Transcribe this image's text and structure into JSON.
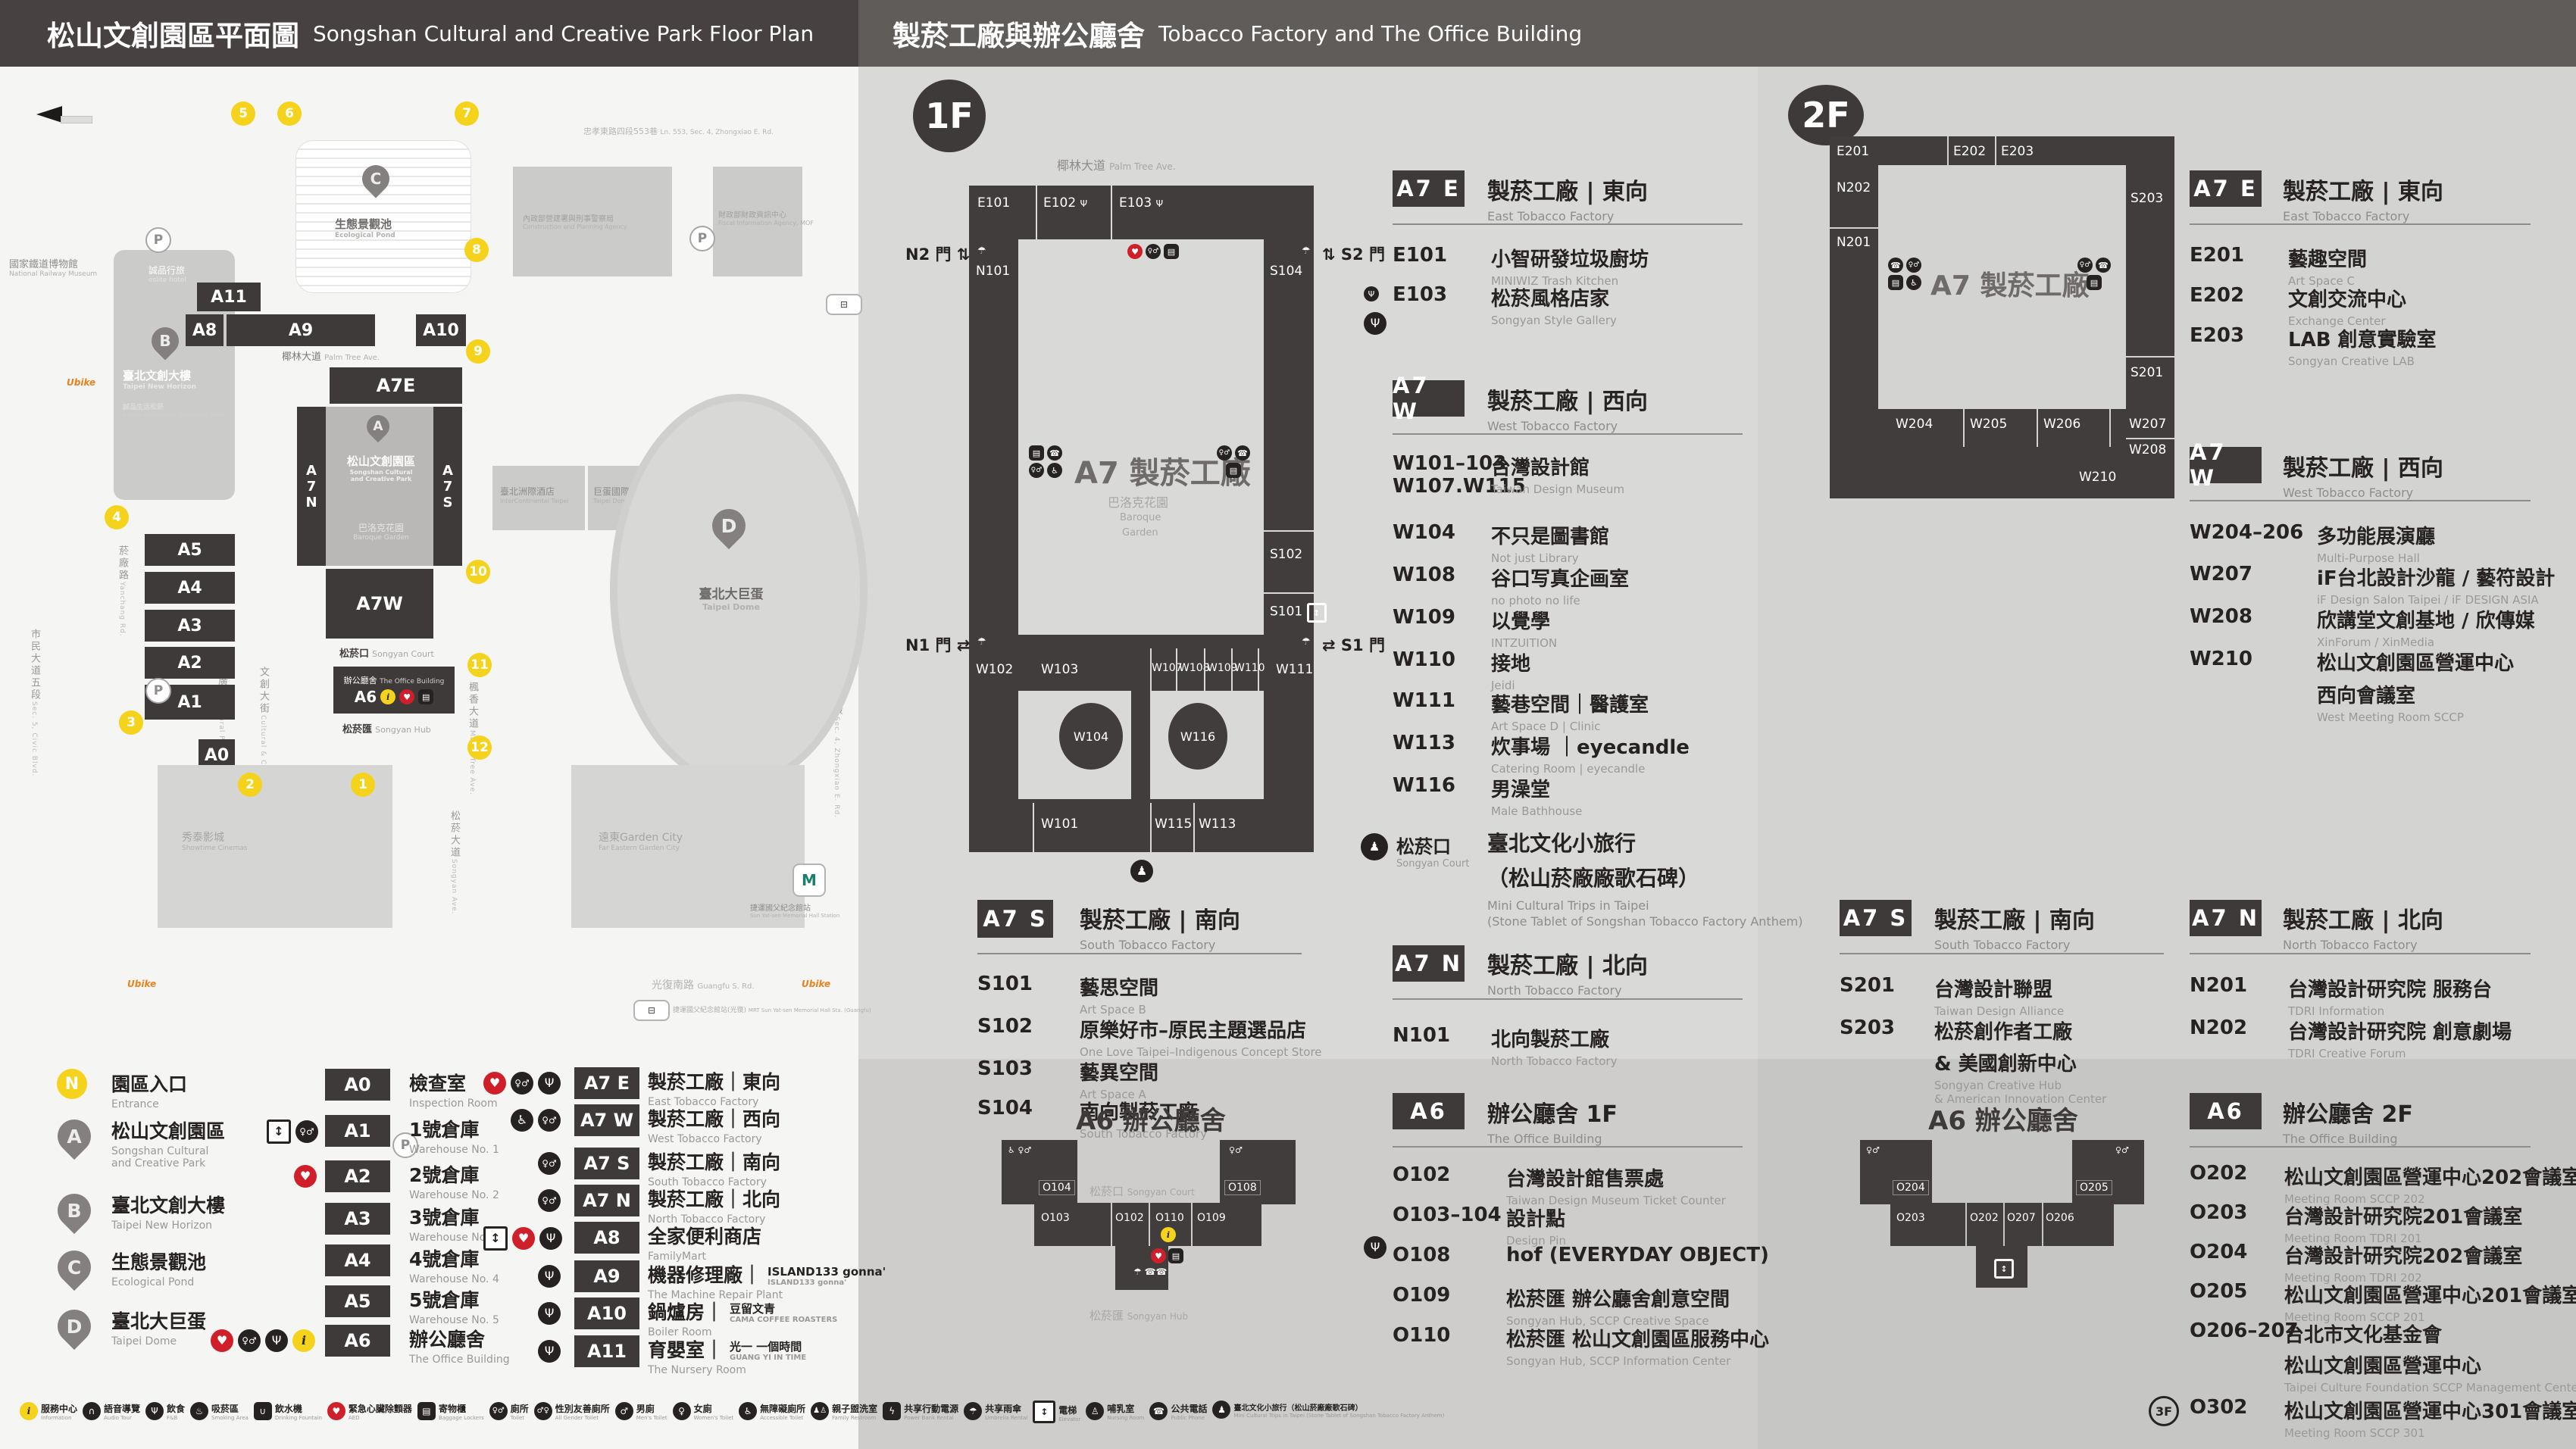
{
  "header": {
    "title_left_zh": "松山文創園區平面圖",
    "title_left_en": "Songshan Cultural and Creative Park Floor Plan",
    "title_right_zh": "製菸工廠與辦公廳舍",
    "title_right_en": "Tobacco Factory and The Office Building"
  },
  "icons": {
    "info": "i",
    "food": "Ψ",
    "restroom": "♀♂",
    "male": "♂",
    "female": "♀",
    "accessible": "♿",
    "aed": "♥",
    "elevator": "↕",
    "locker": "▤",
    "umbrella": "☂",
    "phone": "☎",
    "statue": "♟",
    "audio": "∩",
    "water": "∪",
    "smoking": "♨",
    "family": "♟♙",
    "power": "ϟ",
    "nursing": "♙",
    "parking": "P"
  },
  "map": {
    "compass": "N",
    "roads": {
      "top": {
        "zh": "忠孝東路四段553巷",
        "en": "Ln. 553, Sec. 4, Zhongxiao E. Rd."
      },
      "left_outer": {
        "zh": "市民大道五段",
        "en": "Sec. 5, Civic Blvd."
      },
      "left_inner": {
        "zh": "菸廠路",
        "en": "Yanchang Rd."
      },
      "right": {
        "zh": "忠孝東路四段",
        "en": "Sec. 4, Zhongxiao E. Rd."
      },
      "bottom": {
        "zh": "光復南路",
        "en": "Guangfu S. Rd."
      },
      "songyan": {
        "zh": "松菸大道",
        "en": "Songyan Ave."
      },
      "palm": {
        "zh": "椰林大道",
        "en": "Palm Tree Ave."
      },
      "maple": {
        "zh": "楓香大道",
        "en": "Maple Tree Ave."
      },
      "cultural_blvd": {
        "zh": "文創大街",
        "en": "Cultural & Creative Blvd."
      },
      "cultural_plaza": {
        "zh": "文化廣場",
        "en": "Cultural Plaza"
      }
    },
    "pois": {
      "railway_museum": {
        "zh": "國家鐵道博物館",
        "en": "National Railway Museum"
      },
      "eslite_hotel": {
        "zh": "誠品行旅",
        "en": "eslite hotel"
      },
      "new_horizon": {
        "zh": "臺北文創大樓",
        "en": "Taipei New Horizon"
      },
      "eslite_mall": {
        "zh": "誠品生活松菸",
        "en": "eslite spectrum Songyan Mall"
      },
      "cpa": {
        "zh": "內政部營建署與刑事警察局",
        "en": "Construction and Planning Agency"
      },
      "fia": {
        "zh": "財政部財政資訊中心",
        "en": "Fiscal Information Agency, MOF"
      },
      "intercontinental": {
        "zh": "臺北洲際酒店",
        "en": "InterContinental Taipei"
      },
      "dome_center": {
        "zh": "巨蛋國際中心",
        "en": "Taipei Dome Int'l Center"
      },
      "showtime": {
        "zh": "秀泰影城",
        "en": "Showtime Cinemas"
      },
      "garden_city": {
        "zh": "遠東Garden City",
        "en": "Far Eastern Garden City"
      },
      "mrt": {
        "zh": "捷運國父紀念館站",
        "en": "Sun Yat-sen Memorial Hall Station"
      },
      "bus": {
        "zh": "捷運國父紀念館站(光復)",
        "en": "MRT Sun Yat-sen Memorial Hall Sta. (Guangfu)"
      },
      "ubike": "Ubike"
    },
    "pond": {
      "zh": "生態景觀池",
      "en": "Ecological Pond"
    },
    "dome": {
      "zh": "臺北大巨蛋",
      "en": "Taipei Dome"
    },
    "park": {
      "zh": "松山文創園區",
      "en1": "Songshan Cultural",
      "en2": "and Creative Park"
    },
    "baroque": {
      "zh": "巴洛克花園",
      "en": "Baroque Garden"
    },
    "court": {
      "zh": "松菸口",
      "en": "Songyan Court"
    },
    "hub": {
      "zh": "松菸匯",
      "en": "Songyan Hub"
    },
    "office_bar": {
      "zh": "辦公廳舍",
      "en": "The Office Building",
      "code": "A6"
    },
    "blocks": {
      "a11": "A11",
      "a8": "A8",
      "a9": "A9",
      "a10": "A10",
      "a7e": "A7E",
      "a7w": "A7W",
      "a7n": "A7N",
      "a7s": "A7S",
      "a0": "A0",
      "a1": "A1",
      "a2": "A2",
      "a3": "A3",
      "a4": "A4",
      "a5": "A5"
    },
    "entrances": [
      "1",
      "2",
      "3",
      "4",
      "5",
      "6",
      "7",
      "8",
      "9",
      "10",
      "11",
      "12"
    ]
  },
  "legend": {
    "markers": [
      {
        "key": "N",
        "zh": "園區入口",
        "en": "Entrance"
      },
      {
        "key": "A",
        "zh": "松山文創園區",
        "en1": "Songshan Cultural",
        "en2": "and Creative Park"
      },
      {
        "key": "B",
        "zh": "臺北文創大樓",
        "en1": "Taipei New Horizon",
        "en2": ""
      },
      {
        "key": "C",
        "zh": "生態景觀池",
        "en1": "Ecological Pond",
        "en2": ""
      },
      {
        "key": "D",
        "zh": "臺北大巨蛋",
        "en1": "Taipei Dome",
        "en2": ""
      }
    ],
    "col_a": [
      {
        "code": "A0",
        "zh": "檢查室",
        "en": "Inspection Room"
      },
      {
        "code": "A1",
        "zh": "1號倉庫",
        "en": "Warehouse No. 1"
      },
      {
        "code": "A2",
        "zh": "2號倉庫",
        "en": "Warehouse No. 2"
      },
      {
        "code": "A3",
        "zh": "3號倉庫",
        "en": "Warehouse No. 3"
      },
      {
        "code": "A4",
        "zh": "4號倉庫",
        "en": "Warehouse No. 4"
      },
      {
        "code": "A5",
        "zh": "5號倉庫",
        "en": "Warehouse No. 5"
      },
      {
        "code": "A6",
        "zh": "辦公廳舍",
        "en": "The Office Building"
      }
    ],
    "col_b": [
      {
        "code": "A7 E",
        "zh": "製菸工廠｜東向",
        "en": "East Tobacco Factory"
      },
      {
        "code": "A7 W",
        "zh": "製菸工廠｜西向",
        "en": "West Tobacco Factory"
      },
      {
        "code": "A7 S",
        "zh": "製菸工廠｜南向",
        "en": "South Tobacco Factory"
      },
      {
        "code": "A7 N",
        "zh": "製菸工廠｜北向",
        "en": "North Tobacco Factory"
      },
      {
        "code": "A8",
        "zh": "全家便利商店",
        "en": "FamilyMart"
      },
      {
        "code": "A9",
        "zh": "機器修理廠｜",
        "sub1": "ISLAND133 gonna'",
        "sub2": "ISLAND133 gonna'",
        "en": "The Machine Repair Plant"
      },
      {
        "code": "A10",
        "zh": "鍋爐房｜",
        "sub1": "豆留文青",
        "sub2": "CAMA COFFEE ROASTERS",
        "en": "Boiler Room"
      },
      {
        "code": "A11",
        "zh": "育嬰室｜",
        "sub1": "光一 一個時間",
        "sub2": "GUANG YI IN TIME",
        "en": "The Nursery Room"
      }
    ]
  },
  "f1": {
    "badge": "1F",
    "plan": {
      "e101": "E101",
      "e102": "E102",
      "e103": "E103",
      "n101": "N101",
      "s101": "S101",
      "s102": "S102",
      "s103": "S103",
      "s104": "S104",
      "w101": "W101",
      "w102": "W102",
      "w103": "W103",
      "w104": "W104",
      "w107": "W107",
      "w108": "W108",
      "w109": "W109",
      "w110": "W110",
      "w111": "W111",
      "w113": "W113",
      "w115": "W115",
      "w116": "W116",
      "n1": "N1 門",
      "n2": "N2 門",
      "s1": "S1 門",
      "s2": "S2 門",
      "a7": "A7 製菸工廠"
    },
    "a7e": {
      "code": "A7 E",
      "zh": "製菸工廠 | 東向",
      "en": "East Tobacco Factory",
      "rooms": [
        {
          "code": "E101",
          "zh": "小智研發垃圾廚坊",
          "en": "MINIWIZ Trash Kitchen"
        },
        {
          "code": "E103",
          "zh": "松菸風格店家",
          "en": "Songyan Style Gallery"
        }
      ]
    },
    "a7w": {
      "code": "A7 W",
      "zh": "製菸工廠 | 西向",
      "en": "West Tobacco Factory",
      "rooms": [
        {
          "code": "W101–103",
          "code2": "W107.W115",
          "zh": "台灣設計館",
          "en": "Taiwan Design Museum"
        },
        {
          "code": "W104",
          "zh": "不只是圖書館",
          "en": "Not just Library"
        },
        {
          "code": "W108",
          "zh": "谷口写真企画室",
          "en": "no photo no life"
        },
        {
          "code": "W109",
          "zh": "以覺學",
          "en": "INTZUITION"
        },
        {
          "code": "W110",
          "zh": "接地",
          "en": "Jeidi"
        },
        {
          "code": "W111",
          "zh": "藝巷空間｜醫護室",
          "en": "Art Space D | Clinic"
        },
        {
          "code": "W113",
          "zh": "炊事場 ｜eyecandle",
          "en": "Catering Room | eyecandle"
        },
        {
          "code": "W116",
          "zh": "男澡堂",
          "en": "Male Bathhouse"
        }
      ]
    },
    "a7s": {
      "code": "A7 S",
      "zh": "製菸工廠 | 南向",
      "en": "South Tobacco Factory",
      "rooms": [
        {
          "code": "S101",
          "zh": "藝思空間",
          "en": "Art Space B"
        },
        {
          "code": "S102",
          "zh": "原樂好市–原民主題選品店",
          "en": "One Love Taipei–Indigenous Concept Store"
        },
        {
          "code": "S103",
          "zh": "藝異空間",
          "en": "Art Space A"
        },
        {
          "code": "S104",
          "zh": "南向製菸工廠",
          "en": "South Tobacco Factory"
        }
      ]
    },
    "court": {
      "zh": "松菸口",
      "en": "Songyan Court",
      "name_zh1": "臺北文化小旅行",
      "name_zh2": "（松山菸廠廠歌石碑）",
      "name_en1": "Mini Cultural Trips in Taipei",
      "name_en2": "(Stone Tablet of Songshan Tobacco Factory Anthem)"
    },
    "a7n": {
      "code": "A7 N",
      "zh": "製菸工廠 | 北向",
      "en": "North Tobacco Factory",
      "rooms": [
        {
          "code": "N101",
          "zh": "北向製菸工廠",
          "en": "North Tobacco Factory"
        }
      ]
    },
    "a6": {
      "code": "A6",
      "zh": "辦公廳舍 1F",
      "en": "The Office Building",
      "plan_title": "A6 辦公廳舍",
      "plan_rooms": {
        "o102": "O102",
        "o103": "O103",
        "o104": "O104",
        "o108": "O108",
        "o109": "O109",
        "o110": "O110"
      },
      "rooms": [
        {
          "code": "O102",
          "zh": "台灣設計館售票處",
          "en": "Taiwan Design Museum Ticket Counter"
        },
        {
          "code": "O103–104",
          "zh": "設計點",
          "en": "Design Pin"
        },
        {
          "code": "O108",
          "zh": "hof (EVERYDAY OBJECT)",
          "en": ""
        },
        {
          "code": "O109",
          "zh": "松菸匯 辦公廳舍創意空間",
          "en": "Songyan Hub, SCCP Creative Space"
        },
        {
          "code": "O110",
          "zh": "松菸匯 松山文創園區服務中心",
          "en": "Songyan Hub, SCCP Information Center"
        }
      ]
    }
  },
  "f2": {
    "badge": "2F",
    "plan": {
      "e201": "E201",
      "e202": "E202",
      "e203": "E203",
      "n201": "N201",
      "n202": "N202",
      "s201": "S201",
      "s203": "S203",
      "w204": "W204",
      "w205": "W205",
      "w206": "W206",
      "w207": "W207",
      "w208": "W208",
      "w210": "W210",
      "a7": "A7 製菸工廠"
    },
    "a7e": {
      "code": "A7 E",
      "zh": "製菸工廠 | 東向",
      "en": "East Tobacco Factory",
      "rooms": [
        {
          "code": "E201",
          "zh": "藝趣空間",
          "en": "Art Space C"
        },
        {
          "code": "E202",
          "zh": "文創交流中心",
          "en": "Exchange Center"
        },
        {
          "code": "E203",
          "zh": "LAB 創意實驗室",
          "en": "Songyan Creative LAB"
        }
      ]
    },
    "a7w": {
      "code": "A7 W",
      "zh": "製菸工廠 | 西向",
      "en": "West Tobacco Factory",
      "rooms": [
        {
          "code": "W204–206",
          "zh": "多功能展演廳",
          "en": "Multi-Purpose Hall"
        },
        {
          "code": "W207",
          "zh": "iF台北設計沙龍 / 藝符設計",
          "en": "iF Design Salon Taipei / iF DESIGN ASIA"
        },
        {
          "code": "W208",
          "zh": "欣講堂文創基地 / 欣傳媒",
          "en": "XinForum / XinMedia"
        },
        {
          "code": "W210",
          "zh": "松山文創園區營運中心",
          "zh2": "西向會議室",
          "en": "West Meeting Room SCCP"
        }
      ]
    },
    "a7s": {
      "code": "A7 S",
      "zh": "製菸工廠 | 南向",
      "en": "South Tobacco Factory",
      "rooms": [
        {
          "code": "S201",
          "zh": "台灣設計聯盟",
          "en": "Taiwan Design Alliance"
        },
        {
          "code": "S203",
          "zh": "松菸創作者工廠",
          "zh2": "& 美國創新中心",
          "en1": "Songyan Creative Hub",
          "en2": "& American Innovation Center"
        }
      ]
    },
    "a7n": {
      "code": "A7 N",
      "zh": "製菸工廠 | 北向",
      "en": "North Tobacco Factory",
      "rooms": [
        {
          "code": "N201",
          "zh": "台灣設計研究院 服務台",
          "en": "TDRI Information"
        },
        {
          "code": "N202",
          "zh": "台灣設計研究院 創意劇場",
          "en": "TDRI Creative Forum"
        }
      ]
    },
    "a6": {
      "code": "A6",
      "zh": "辦公廳舍 2F",
      "en": "The Office Building",
      "plan_title": "A6 辦公廳舍",
      "plan_rooms": {
        "o202": "O202",
        "o203": "O203",
        "o204": "O204",
        "o205": "O205",
        "o206": "O206",
        "o207": "O207"
      },
      "rooms": [
        {
          "code": "O202",
          "zh": "松山文創園區營運中心202會議室",
          "en": "Meeting Room SCCP 202"
        },
        {
          "code": "O203",
          "zh": "台灣設計研究院201會議室",
          "en": "Meeting Room TDRI 201"
        },
        {
          "code": "O204",
          "zh": "台灣設計研究院202會議室",
          "en": "Meeting Room TDRI 202"
        },
        {
          "code": "O205",
          "zh": "松山文創園區營運中心201會議室",
          "en": "Meeting Room SCCP 201"
        },
        {
          "code": "O206–207",
          "zh": "台北市文化基金會",
          "zh2": "松山文創園區營運中心",
          "en": "Taipei Culture Foundation SCCP Management Center"
        },
        {
          "code": "O302",
          "floor": "3F",
          "zh": "松山文創園區營運中心301會議室",
          "en": "Meeting Room SCCP 301"
        }
      ]
    }
  },
  "strip": [
    {
      "icon": "info-icon",
      "g": "i",
      "zh": "服務中心",
      "en": "Information"
    },
    {
      "icon": "audio-tour-icon",
      "g": "∩",
      "zh": "語音導覽",
      "en": "Audio Tour"
    },
    {
      "icon": "food-icon",
      "g": "Ψ",
      "zh": "飲食",
      "en": "F&B"
    },
    {
      "icon": "smoking-icon",
      "g": "♨",
      "zh": "吸菸區",
      "en": "Smoking Area"
    },
    {
      "icon": "water-icon",
      "g": "∪",
      "zh": "飲水機",
      "en": "Drinking Fountain"
    },
    {
      "icon": "aed-icon",
      "g": "♥",
      "zh": "緊急心臟除顫器",
      "en": "AED"
    },
    {
      "icon": "locker-icon",
      "g": "▤",
      "zh": "寄物櫃",
      "en": "Baggage Lockers"
    },
    {
      "icon": "toilet-icon",
      "g": "♀♂",
      "zh": "廁所",
      "en": "Toilet"
    },
    {
      "icon": "all-gender-toilet-icon",
      "g": "♂♀",
      "zh": "性別友善廁所",
      "en": "All Gender Toilet"
    },
    {
      "icon": "mens-toilet-icon",
      "g": "♂",
      "zh": "男廁",
      "en": "Men's Toilet"
    },
    {
      "icon": "womens-toilet-icon",
      "g": "♀",
      "zh": "女廁",
      "en": "Women's Toilet"
    },
    {
      "icon": "accessible-toilet-icon",
      "g": "♿",
      "zh": "無障礙廁所",
      "en": "Accessible Toilet"
    },
    {
      "icon": "family-restroom-icon",
      "g": "♟♙",
      "zh": "親子盥洗室",
      "en": "Family Restroom"
    },
    {
      "icon": "power-bank-icon",
      "g": "ϟ",
      "zh": "共享行動電源",
      "en": "Power Bank Rental"
    },
    {
      "icon": "umbrella-icon",
      "g": "☂",
      "zh": "共享雨傘",
      "en": "Umbrella Rental"
    },
    {
      "icon": "elevator-icon",
      "g": "↕",
      "zh": "電梯",
      "en": "Elevator"
    },
    {
      "icon": "nursing-icon",
      "g": "♙",
      "zh": "哺乳室",
      "en": "Nursing Room"
    },
    {
      "icon": "phone-icon",
      "g": "☎",
      "zh": "公共電話",
      "en": "Public Phone"
    },
    {
      "icon": "culture-trip-icon",
      "g": "♟",
      "zh": "臺北文化小旅行（松山菸廠廠歌石碑）",
      "en": "Mini Cultural Trips in Taipei (Stone Tablet of Songshan Tobacco Factory Anthem)"
    }
  ]
}
